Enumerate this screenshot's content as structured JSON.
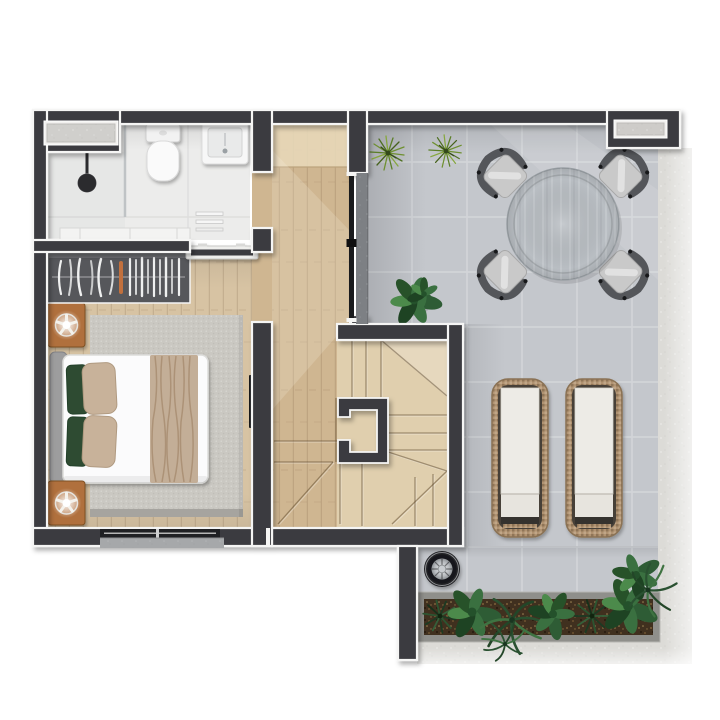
{
  "scene": {
    "kind": "architectural-floor-plan",
    "style": "photorealistic-top-down-3d-render",
    "level": "upper floor apartment with roof terrace",
    "background": "#ffffff"
  },
  "colors": {
    "wall": "#3b3b40",
    "wall_edge": "#f5f5f4",
    "bathroom_floor": "#ececeb",
    "wood_hall": "#cfb691",
    "wood_bedroom": "#d7c3a3",
    "wood_stairs": "#e0cfae",
    "wood_mat": "#e7d7b8",
    "terrace_tile": "#c4c7cc",
    "tile_grout": "#d3d5d9",
    "plaster": "#dcdbd7",
    "rug": "#cac8c2",
    "rug_edge": "#a6a49f",
    "wardrobe": "#56575b",
    "table_wood": "#b9bec3",
    "chair_frame": "#54565a",
    "chair_cushion": "#c9c9c9",
    "duvet": "#fbfbfc",
    "headboard": "#9d9d9e",
    "throw": "#c3ae97",
    "pillow_green": "#2f4c33",
    "pillow_beige": "#c8b29a",
    "planter_stone": "#8f8f8b",
    "soil": "#40301f",
    "rattan": "#b09271",
    "lounger_cushion": "#edebe6",
    "nightstand_wood": "#b06f3d",
    "plant_green": "#3c6b41",
    "grass_green": "#6e9030",
    "grill_dark": "#232427",
    "grill_steel": "#c9ccd0",
    "glass_dark": "#1a1b1d",
    "sill": "#a6a8aa"
  },
  "rooms": [
    {
      "name": "bathroom",
      "furniture": [
        "walk-in-shower",
        "ceiling-shower-head",
        "glass-partition",
        "toilet-with-cistern",
        "washbasin-counter",
        "towel-rack",
        "vanity-shelf",
        "window"
      ]
    },
    {
      "name": "bedroom",
      "furniture": [
        "open-wardrobe-with-clothes",
        "double-bed",
        "upholstered-headboard",
        "green-pillows",
        "beige-pillows",
        "throw-blanket",
        "area-rug",
        "nightstand-with-lamp-left",
        "nightstand-with-lamp-right",
        "wall-mounted-tv",
        "sliding-glass-door"
      ]
    },
    {
      "name": "hallway",
      "furniture": [
        "entry-mat",
        "pocket-door-to-bathroom",
        "parked-sliding-door",
        "sliding-glass-door-to-terrace"
      ]
    },
    {
      "name": "staircase",
      "furniture": [
        "u-shaped-winder-stair",
        "stair-core-wall"
      ]
    },
    {
      "name": "roof-terrace",
      "furniture": [
        "round-dining-table",
        "dining-chairs",
        "sun-loungers",
        "barbecue-grill",
        "planter-box-with-plants",
        "ornamental-grasses",
        "potted-plant",
        "concrete-ledge"
      ]
    }
  ],
  "counts": {
    "dining_chairs": 4,
    "sun_loungers": 2,
    "ornamental_grasses": 2,
    "nightstands": 2,
    "windows": 2
  }
}
